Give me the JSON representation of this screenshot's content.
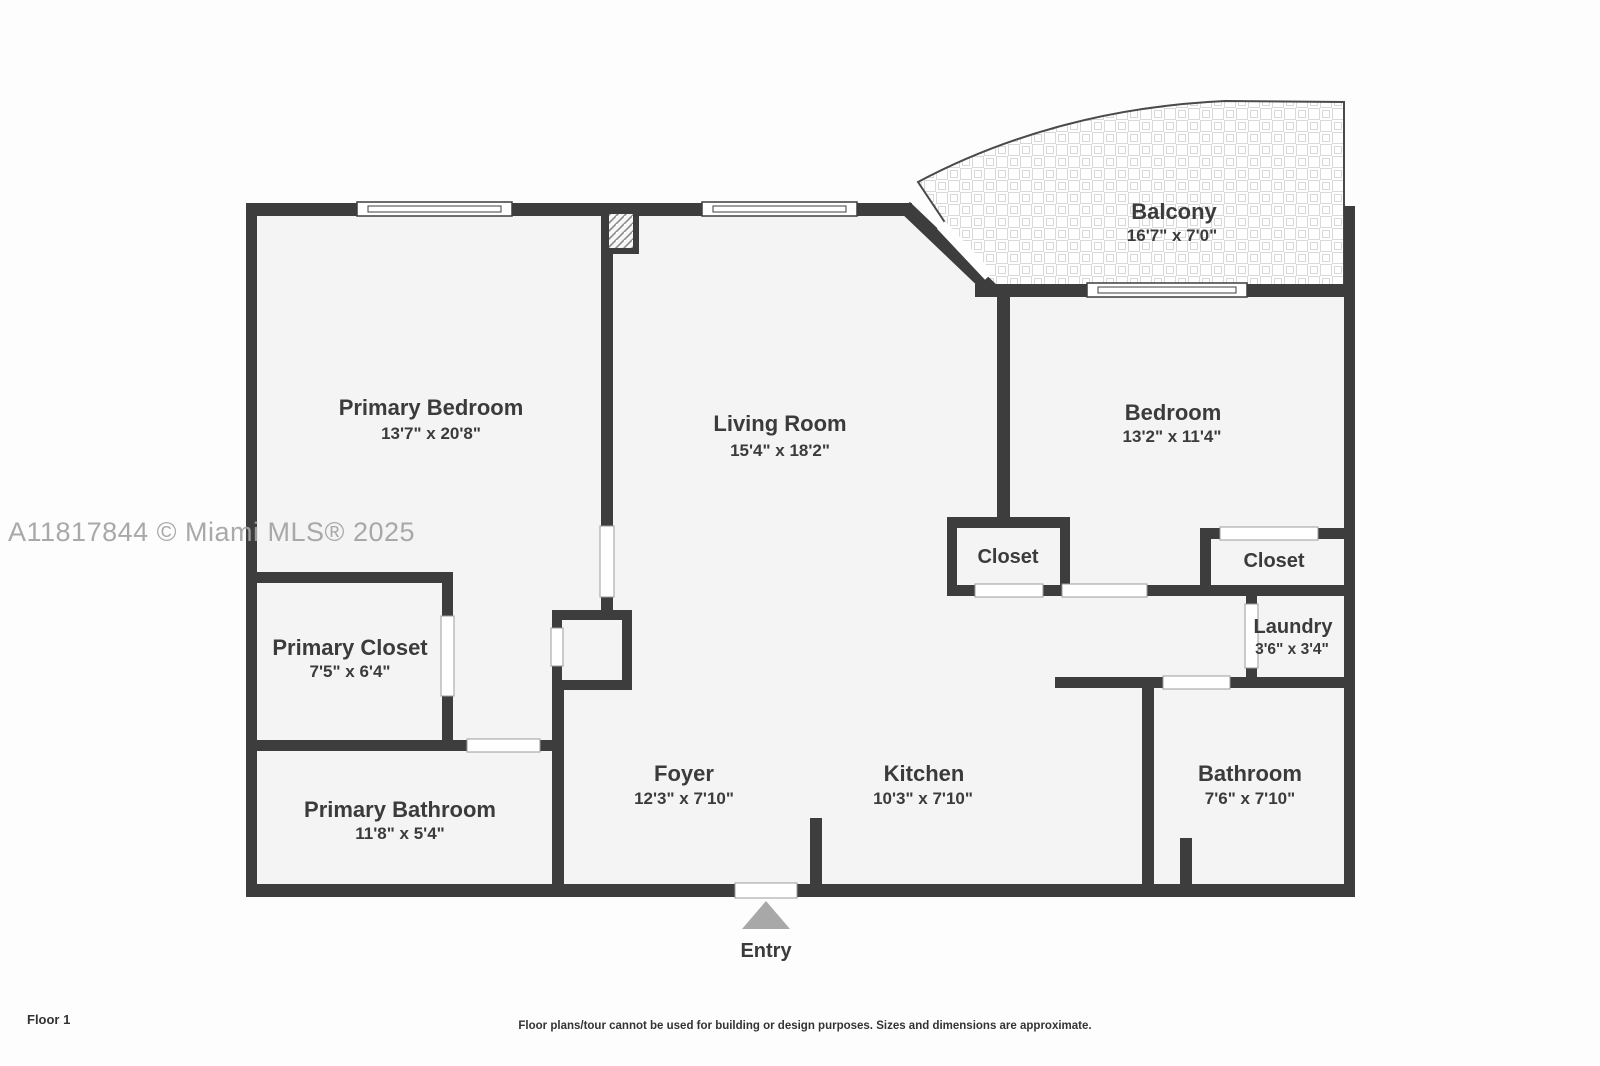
{
  "watermark": {
    "text": "A11817844 © Miami MLS® 2025",
    "color": "#a2a2a2"
  },
  "footer": {
    "floor_label": "Floor 1",
    "disclaimer": "Floor plans/tour cannot be used for building or design purposes. Sizes and dimensions are approximate."
  },
  "colors": {
    "wall": "#3d3d3d",
    "room_fill": "#f4f4f4",
    "outside_background": "#fdfdfd",
    "label_text": "#3b3b3b",
    "entry_arrow": "#a8a8a8",
    "door_gap_outline": "#9b9b9b"
  },
  "rooms": {
    "balcony": {
      "name": "Balcony",
      "dims": "16'7\" x 7'0\""
    },
    "primary_bedroom": {
      "name": "Primary Bedroom",
      "dims": "13'7\" x 20'8\""
    },
    "living_room": {
      "name": "Living Room",
      "dims": "15'4\" x 18'2\""
    },
    "bedroom": {
      "name": "Bedroom",
      "dims": "13'2\" x 11'4\""
    },
    "living_room_closet": {
      "name": "Closet"
    },
    "bedroom_closet": {
      "name": "Closet"
    },
    "laundry": {
      "name": "Laundry",
      "dims": "3'6\" x 3'4\""
    },
    "primary_closet": {
      "name": "Primary Closet",
      "dims": "7'5\" x 6'4\""
    },
    "primary_bathroom": {
      "name": "Primary Bathroom",
      "dims": "11'8\" x 5'4\""
    },
    "foyer": {
      "name": "Foyer",
      "dims": "12'3\" x 7'10\""
    },
    "kitchen": {
      "name": "Kitchen",
      "dims": "10'3\" x 7'10\""
    },
    "bathroom": {
      "name": "Bathroom",
      "dims": "7'6\" x 7'10\""
    },
    "entry": {
      "name": "Entry"
    }
  }
}
